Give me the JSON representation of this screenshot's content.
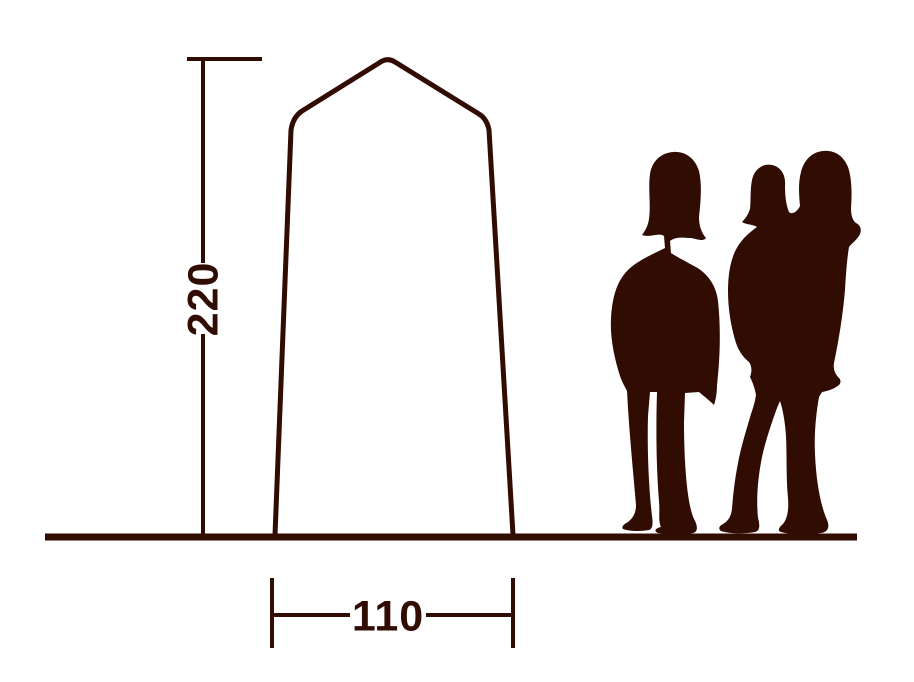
{
  "colors": {
    "ink": "#310c03",
    "background": "#ffffff"
  },
  "diagram": {
    "subject": "tent dimension diagram",
    "height_dimension": {
      "value": "220"
    },
    "width_dimension": {
      "value": "110"
    }
  },
  "figures": {
    "left": "adult-silhouette",
    "right": "adult-carrying-child-silhouette"
  }
}
